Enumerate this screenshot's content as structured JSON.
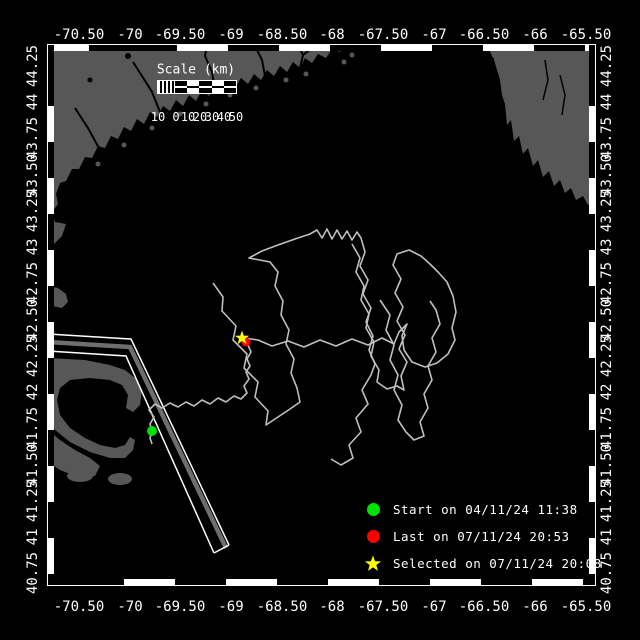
{
  "axes": {
    "lon": [
      "-70.50",
      "-70",
      "-69.50",
      "-69",
      "-68.50",
      "-68",
      "-67.50",
      "-67",
      "-66.50",
      "-66",
      "-65.50"
    ],
    "lat": [
      "44.25",
      "44",
      "43.75",
      "43.50",
      "43.25",
      "43",
      "42.75",
      "42.50",
      "42.25",
      "42",
      "41.75",
      "41.50",
      "41.25",
      "41",
      "40.75"
    ]
  },
  "scale_bar": {
    "title": "Scale (km)",
    "labels": [
      "10",
      "0",
      "10",
      "20",
      "30",
      "40",
      "50"
    ]
  },
  "legend": {
    "items": [
      {
        "marker": "green-dot",
        "color": "#00e100",
        "label": "Start on 04/11/24 11:38"
      },
      {
        "marker": "red-dot",
        "color": "#ff0000",
        "label": "Last on 07/11/24 20:53"
      },
      {
        "marker": "yellow-star",
        "color": "#ffff00",
        "label": "Selected on 07/11/24 20:08"
      }
    ]
  },
  "colors": {
    "ocean": "#000000",
    "land": "#575757",
    "track": "#bfbfbf",
    "frame": "#ffffff",
    "lane_stripe": "#6e6e6e",
    "start": "#00e100",
    "last": "#ff0000",
    "selected": "#ffff00"
  }
}
